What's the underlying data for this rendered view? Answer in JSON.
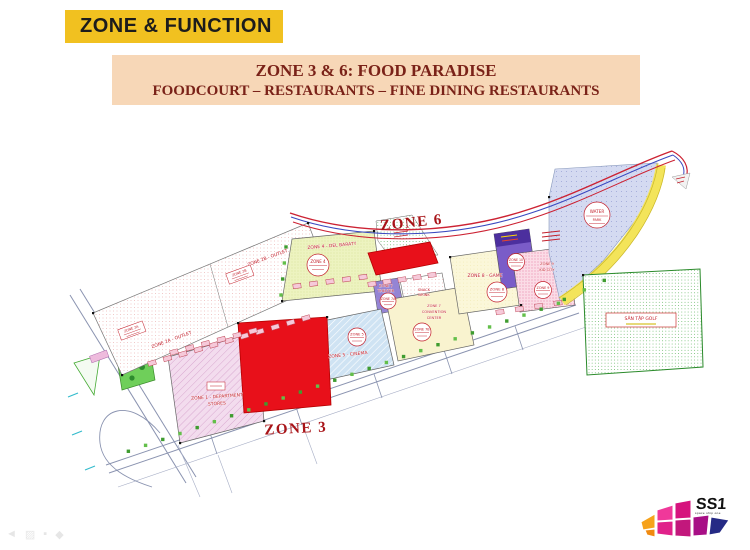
{
  "slide": {
    "header": "ZONE & FUNCTION",
    "banner_line1": "ZONE 3 & 6: FOOD PARADISE",
    "banner_line2": "FOODCOURT – RESTAURANTS – FINE DINING RESTAURANTS"
  },
  "map": {
    "zone6_label": "ZONE 6",
    "zone3_label": "ZONE 3",
    "zone2a_outlet": "ZONE 2A - OUTLET",
    "zone2b_outlet": "ZONE 2B - OUTLET",
    "zone1_line1": "ZONE 1 - DEPARTMENT",
    "zone1_line2": "STORES",
    "zone4_label": "ZONE 4 - DEL BARATY",
    "zone5_cinema": "ZONE 5 - CINEMA",
    "zone7_theater_l1": "ZONE 7",
    "zone7_theater_l2": "THEATER",
    "zone7_conv_l1": "ZONE 7",
    "zone7_conv_l2": "CONVENTION",
    "zone7_conv_l3": "CENTER",
    "zone8_game": "ZONE 8 - GAME",
    "zone9_l1": "ZONE 9",
    "zone9_l2": "KID CITY",
    "snack_l1": "SNACK",
    "snack_l2": "DRINK",
    "golf_label": "SÂN TẬP GOLF",
    "badges": {
      "zone4": "ZONE 4",
      "zone5": "ZONE 5",
      "zone7a": "ZONE 7A",
      "zone7b": "ZONE 7B",
      "zone8": "ZONE 8",
      "zone9": "ZONE 9",
      "zone10": "ZONE 10",
      "water_l1": "WATER",
      "water_l2": "PARK",
      "zone2a": "ZONE 2A",
      "zone2b": "ZONE 2B"
    }
  },
  "logo": {
    "name": "SS1",
    "tagline": "space ship one"
  },
  "colors": {
    "header_bg": "#f1c120",
    "banner_bg": "#f7d7b7",
    "highlight_red": "#e8101a",
    "label_red": "#a81418"
  }
}
